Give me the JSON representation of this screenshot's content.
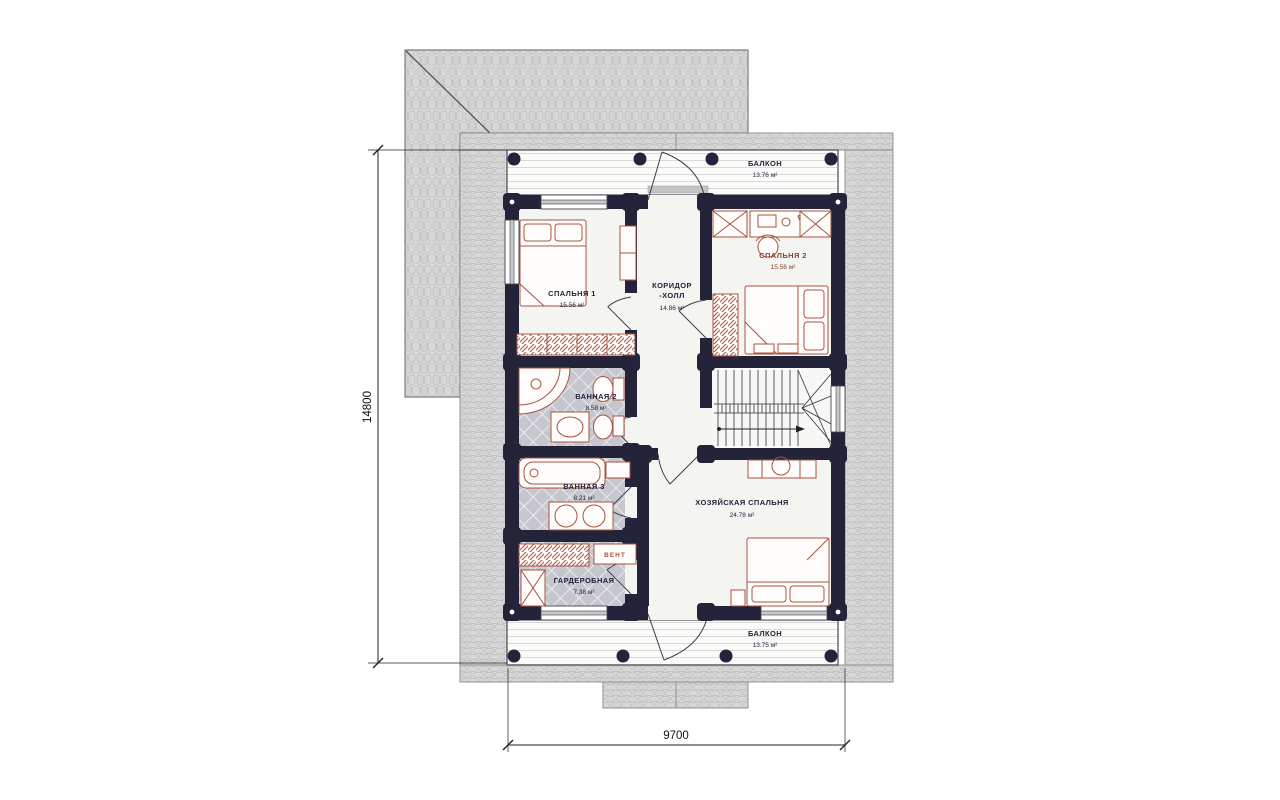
{
  "floorplan": {
    "dimension_left": "14800",
    "dimension_bottom": "9700",
    "rooms": {
      "balcony_top": {
        "name": "БАЛКОН",
        "area": "13.76 м²"
      },
      "bedroom1": {
        "name": "СПАЛЬНЯ 1",
        "area": "15.56 м²"
      },
      "bedroom2": {
        "name": "СПАЛЬНЯ 2",
        "area": "15.56 м²"
      },
      "corridor": {
        "name_line1": "КОРИДОР",
        "name_line2": "-ХОЛЛ",
        "area": "14.86 м²"
      },
      "bath2": {
        "name": "ВАННАЯ 2",
        "area": "8.58 м²"
      },
      "bath3": {
        "name": "ВАННАЯ 3",
        "area": "8.21 м²"
      },
      "master_bedroom": {
        "name": "ХОЗЯЙСКАЯ СПАЛЬНЯ",
        "area": "24.78 м²"
      },
      "wardrobe": {
        "name": "ГАРДЕРОБНАЯ",
        "area": "7.38 м²"
      },
      "vent": {
        "name": "ВЕНТ"
      },
      "balcony_bottom": {
        "name": "БАЛКОН",
        "area": "13.75 м²"
      }
    },
    "colors": {
      "wall": "#232339",
      "furniture": "#a8523e",
      "roof": "#dcdcdc",
      "tile_floor": "#c6c6cf",
      "label": "#23233c",
      "label_accent": "#8a4436"
    }
  }
}
